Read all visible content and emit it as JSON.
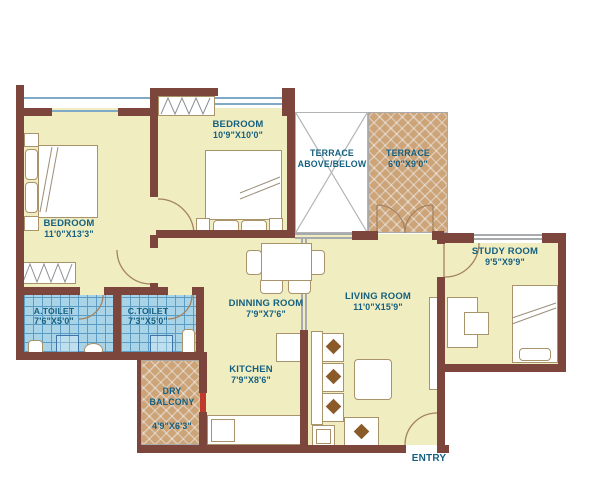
{
  "palette": {
    "wall": "#7d463c",
    "floor": "#f0edc0",
    "toilet_tile": "#a9d4e8",
    "terrace_hatch": "#cda478",
    "label_text": "#156080",
    "window_line": "#7fa9c6",
    "balcony_door": "#c0392b"
  },
  "rooms": {
    "bedroom1": {
      "name": "BEDROOM",
      "dims": "11'0\"X13'3\""
    },
    "bedroom2": {
      "name": "BEDROOM",
      "dims": "10'9\"X10'0\""
    },
    "terrace_above_below": {
      "name": "TERRACE",
      "name2": "ABOVE/BELOW"
    },
    "terrace": {
      "name": "TERRACE",
      "dims": "6'0\"X9'0\""
    },
    "study_room": {
      "name": "STUDY ROOM",
      "dims": "9'5\"X9'9\""
    },
    "a_toilet": {
      "name": "A.TOILET",
      "dims": "7'6\"X5'0\""
    },
    "c_toilet": {
      "name": "C.TOILET",
      "dims": "7'3\"X5'0\""
    },
    "dinning_room": {
      "name": "DINNING ROOM",
      "dims": "7'9\"X7'6\""
    },
    "living_room": {
      "name": "LIVING ROOM",
      "dims": "11'0\"X15'9\""
    },
    "kitchen": {
      "name": "KITCHEN",
      "dims": "7'9\"X8'6\""
    },
    "dry_balcony": {
      "name": "DRY",
      "name2": "BALCONY",
      "dims": "4'9\"X6'3\""
    }
  },
  "entry": {
    "label": "ENTRY"
  }
}
